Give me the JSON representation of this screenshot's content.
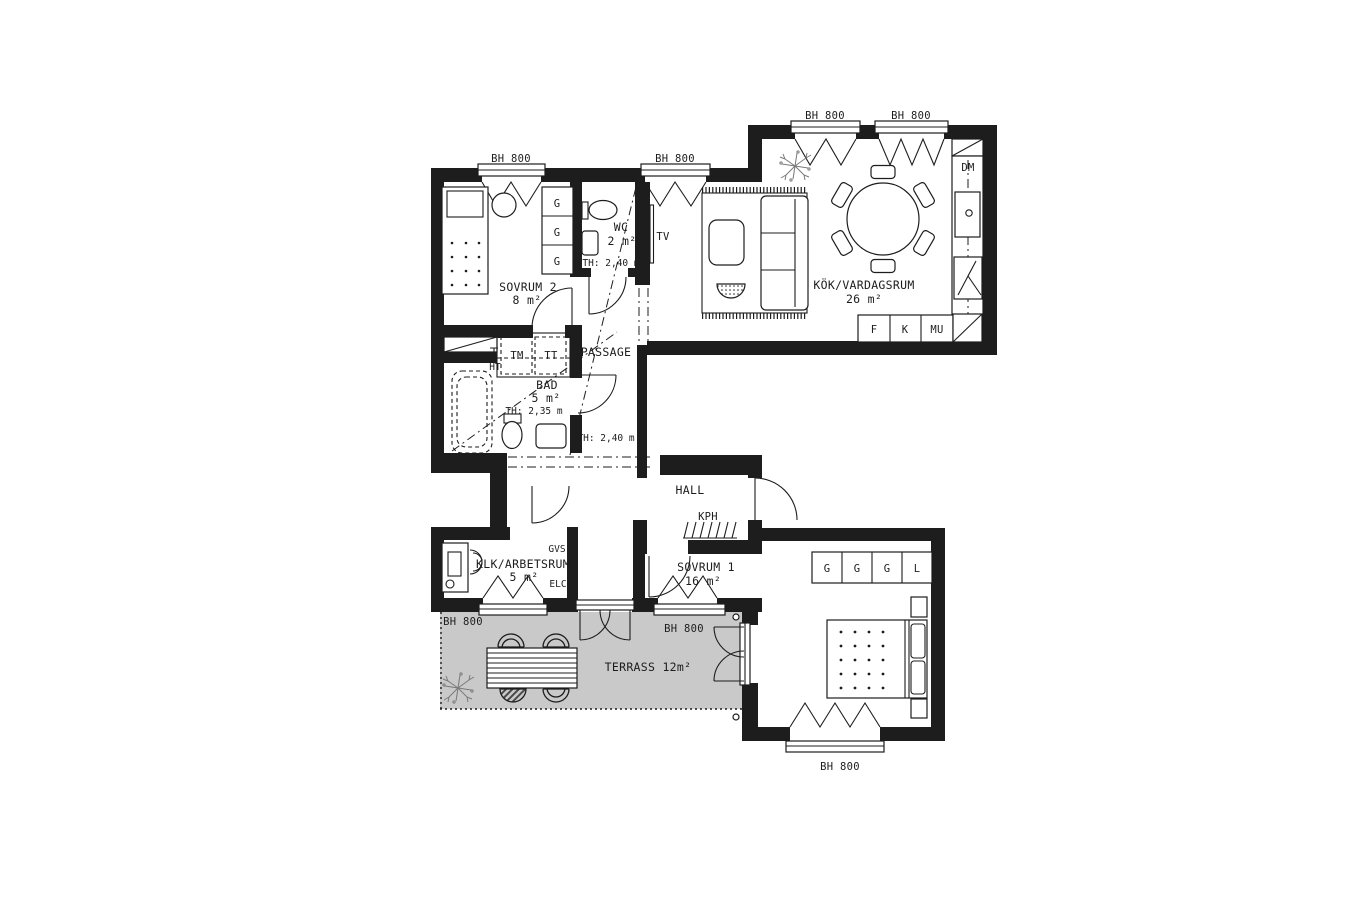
{
  "plan_colors": {
    "wall": "#1d1d1d",
    "terrace_fill": "#c9c9c9",
    "background": "#ffffff",
    "plant": "#7a7a7a"
  },
  "window_label": "BH 800",
  "rooms": {
    "sovrum2": {
      "name": "SOVRUM 2",
      "area": "8 m²"
    },
    "wc": {
      "name": "WC",
      "area": "2 m²",
      "ceiling_height": "TH: 2,40 m"
    },
    "kok_vardagsrum": {
      "name": "KÖK/VARDAGSRUM",
      "area": "26 m²"
    },
    "bad": {
      "name": "BAD",
      "area": "5 m²",
      "ceiling_height": "TH: 2,35 m"
    },
    "passage": {
      "name": "PASSAGE",
      "ceiling_height": "TH: 2,40 m"
    },
    "hall": {
      "name": "HALL"
    },
    "klk_arbetsrum": {
      "name": "KLK/ARBETSRUM",
      "area": "5 m²"
    },
    "sovrum1": {
      "name": "SOVRUM 1",
      "area": "16 m²"
    },
    "terrass": {
      "name": "TERRASS 12m²"
    }
  },
  "labels": {
    "bh800": "BH 800",
    "wardrobe_g": "G",
    "linen_l": "L",
    "tv": "TV",
    "dishwasher_dm": "DM",
    "fridge_f": "F",
    "freezer_k": "K",
    "micro_mu": "MU",
    "washer_tm": "TM",
    "dryer_tt": "TT",
    "towel_ht": "HT",
    "gvs": "GVS",
    "elc": "ELC",
    "coatrack_kph": "KPH"
  }
}
